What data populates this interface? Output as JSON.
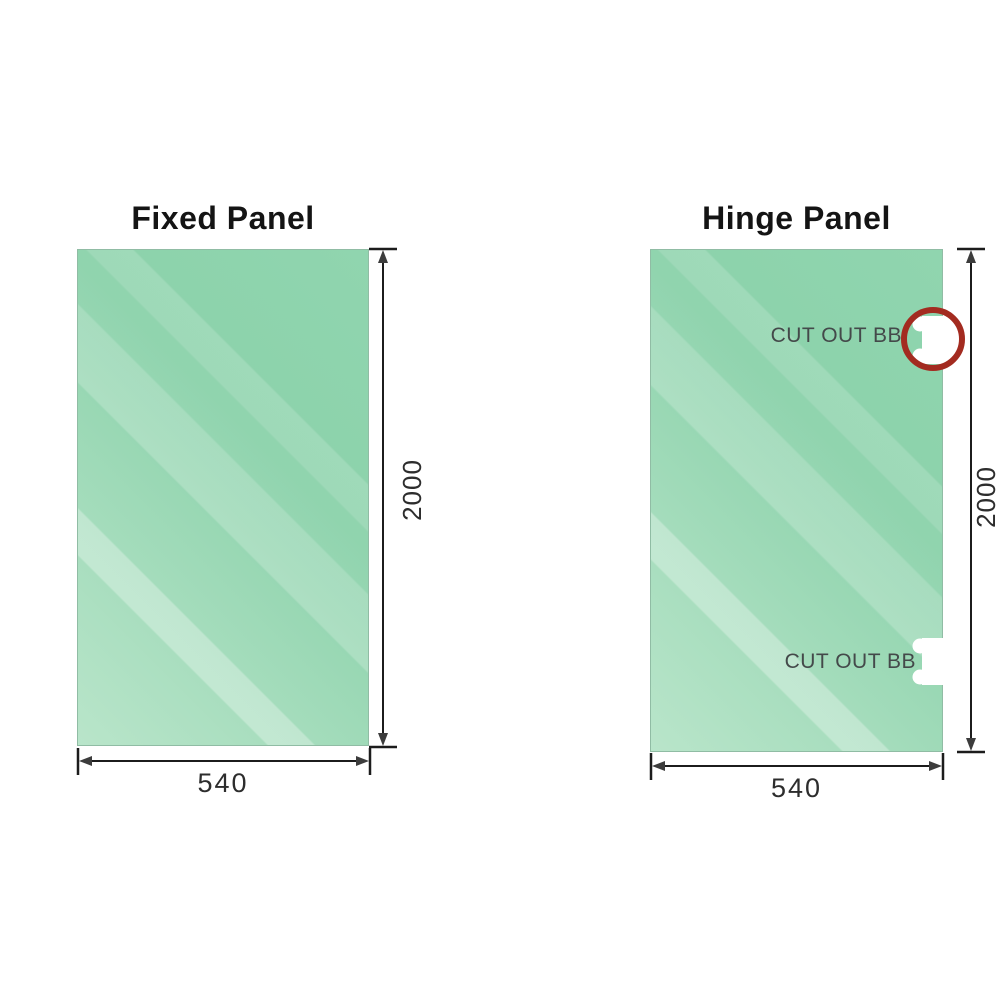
{
  "fixed_panel": {
    "title": "Fixed Panel",
    "height_dim": "2000",
    "width_dim": "540"
  },
  "hinge_panel": {
    "title": "Hinge Panel",
    "height_dim": "2000",
    "width_dim": "540",
    "cutout_top_label": "CUT OUT BB",
    "cutout_bottom_label": "CUT OUT BB"
  },
  "colors": {
    "glass_green": "#8cd2ab",
    "glass_light": "#b9e5ca",
    "dimension_line": "#1c1c1c",
    "arrowhead": "#3c3c3c",
    "cutout_label_text": "#44494a",
    "highlight_circle_red": "#a32b20"
  }
}
